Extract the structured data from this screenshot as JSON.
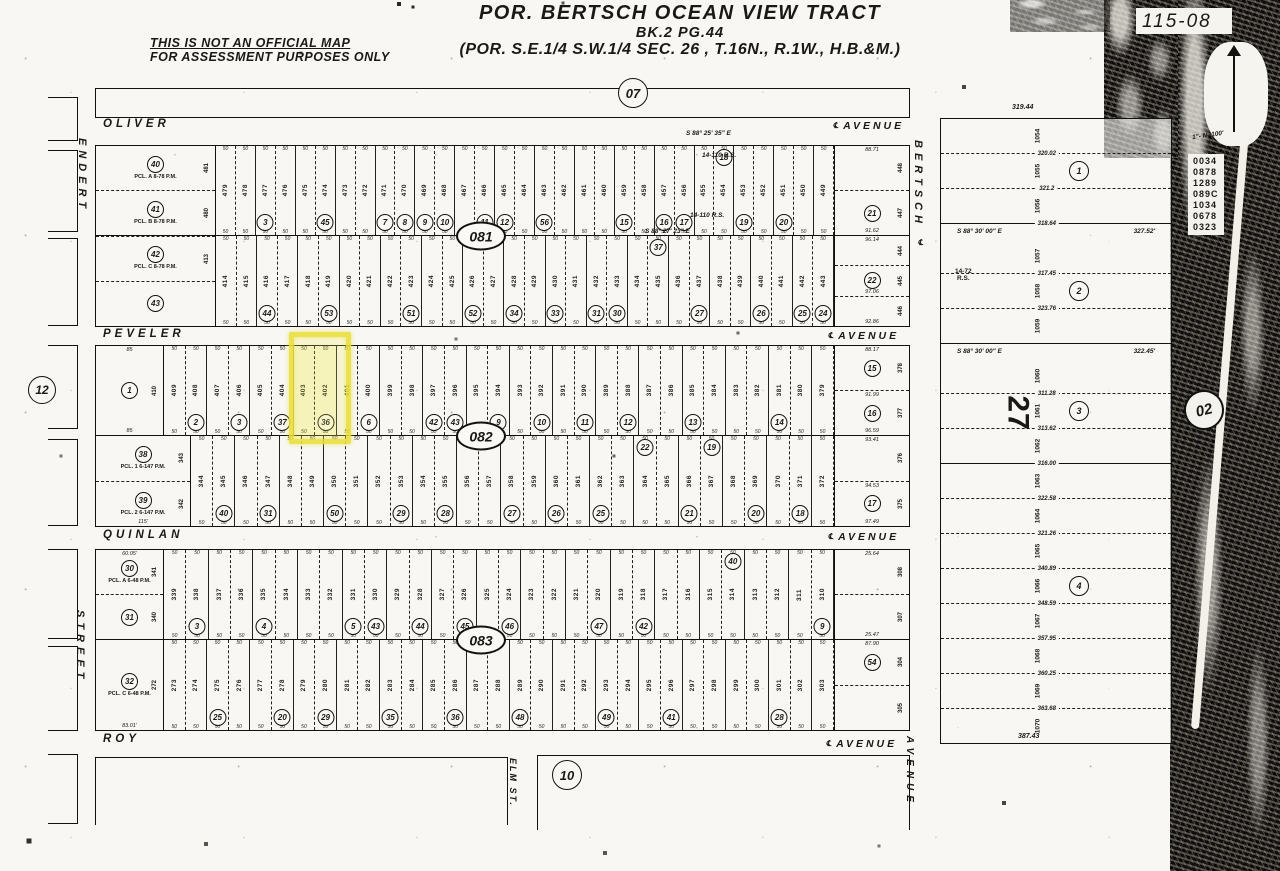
{
  "header": {
    "title_line1": "POR. BERTSCH OCEAN VIEW TRACT",
    "title_line2": "BK.2 PG.44",
    "title_line3": "(POR.  S.E.1/4  S.W.1/4  SEC. 26 ,  T.16N.,  R.1W.,  H.B.&M.)",
    "disclaimer_line1": "THIS IS NOT AN OFFICIAL MAP",
    "disclaimer_line2": "FOR ASSESSMENT PURPOSES ONLY",
    "sheet_number": "115-08",
    "north_scale": "1\"- N -100'"
  },
  "block_labels": {
    "b07": "07",
    "b081": "081",
    "b082": "082",
    "b083": "083",
    "b10": "10",
    "b12": "12",
    "b02": "02"
  },
  "streets": {
    "oliver": {
      "name": "OLIVER",
      "type": "AVENUE"
    },
    "peveler": {
      "name": "PEVELER",
      "type": "AVENUE"
    },
    "quinlan": {
      "name": "QUINLAN",
      "type": "AVENUE"
    },
    "roy": {
      "name": "ROY",
      "type": "AVENUE"
    },
    "endert": {
      "name": "ENDERT",
      "type": "STREET"
    },
    "bertsch": {
      "name": "BERTSCH",
      "type": "AVENUE"
    },
    "elm": {
      "name": "ELM ST."
    },
    "centerline_symbol": "℄"
  },
  "dims": {
    "lot_width": "50"
  },
  "notes": {
    "rs_110_a": "14-110 R.S.",
    "rs_110_b": "14-110 R.S.",
    "bearing_top": "S 88° 25' 35\" E",
    "bearing_mid": "S 88° 27' 23\" E",
    "rs_72": "14-72\nR.S."
  },
  "highlight": {
    "parcel_circle": "36",
    "lots": [
      "403",
      "402"
    ],
    "color": "#e8de3a"
  },
  "grid": {
    "b081": {
      "corner_left": [
        {
          "circle": "40",
          "note": "PCL. A 8-78 P.M.",
          "lot": "481"
        },
        {
          "circle": "41",
          "note": "PCL. B 8-78 P.M.",
          "lot": "480"
        },
        {
          "circle": "42",
          "note": "PCL. C 8-78 P.M.",
          "lot": "413"
        },
        {
          "circle": "43"
        }
      ],
      "rowA": {
        "lots": [
          "479",
          "478",
          {
            "n": "477",
            "c": "3"
          },
          "476",
          "475",
          {
            "n": "474",
            "c": "45"
          },
          "473",
          "472",
          {
            "n": "471",
            "c": "7"
          },
          {
            "n": "470",
            "c": "8"
          },
          {
            "n": "469",
            "c": "9"
          },
          {
            "n": "468",
            "c": "10"
          },
          "467",
          {
            "n": "466",
            "c": "11"
          },
          {
            "n": "465",
            "c": "12"
          },
          "464",
          {
            "n": "463",
            "c": "56"
          },
          "462",
          "461",
          "460",
          {
            "n": "459",
            "c": "15"
          },
          "458",
          {
            "n": "457",
            "c": "16"
          },
          {
            "n": "456",
            "c": "17"
          },
          "455",
          {
            "n": "454",
            "c": "18",
            "t": true
          },
          {
            "n": "453",
            "c": "19"
          },
          "452",
          {
            "n": "451",
            "c": "20"
          },
          "450",
          "449"
        ],
        "corner_right": [
          {
            "lot": "448",
            "dim_top": "88.71"
          },
          {
            "lot": "447",
            "circle": "21",
            "dim": "91.62"
          }
        ]
      },
      "rowB": {
        "lots": [
          "414",
          "415",
          {
            "n": "416",
            "c": "44"
          },
          "417",
          "418",
          {
            "n": "419",
            "c": "53"
          },
          "420",
          "421",
          "422",
          {
            "n": "423",
            "c": "51"
          },
          "424",
          "425",
          {
            "n": "426",
            "c": "52"
          },
          "427",
          {
            "n": "428",
            "c": "34"
          },
          "429",
          {
            "n": "430",
            "c": "33"
          },
          "431",
          {
            "n": "432",
            "c": "31"
          },
          {
            "n": "433",
            "c": "30"
          },
          "434",
          {
            "n": "435",
            "c": "37",
            "t": true
          },
          "436",
          {
            "n": "437",
            "c": "27"
          },
          "438",
          "439",
          {
            "n": "440",
            "c": "26"
          },
          "441",
          {
            "n": "442",
            "c": "25"
          },
          {
            "n": "443",
            "c": "24"
          }
        ],
        "corner_right": [
          {
            "lot": "444",
            "dim_top": "96.14"
          },
          {
            "lot": "445",
            "circle": "22",
            "dim": "97.06"
          },
          {
            "lot": "446",
            "dim": "92.86"
          }
        ]
      }
    },
    "b082": {
      "rowA": {
        "corner_left": [
          {
            "circle": "1",
            "lot": "410",
            "dim_top": "85",
            "dim": "85"
          }
        ],
        "lots": [
          "409",
          {
            "n": "408",
            "c": "2"
          },
          "407",
          {
            "n": "406",
            "c": "3"
          },
          "405",
          {
            "n": "404",
            "c": "37"
          },
          {
            "n": "403",
            "hl": true
          },
          {
            "n": "402",
            "c": "36",
            "hl": true
          },
          "401",
          {
            "n": "400",
            "c": "6"
          },
          "399",
          "398",
          {
            "n": "397",
            "c": "42"
          },
          {
            "n": "396",
            "c": "43"
          },
          "395",
          {
            "n": "394",
            "c": "9"
          },
          "393",
          {
            "n": "392",
            "c": "10"
          },
          "391",
          {
            "n": "390",
            "c": "11"
          },
          "389",
          {
            "n": "388",
            "c": "12"
          },
          "387",
          "386",
          {
            "n": "385",
            "c": "13"
          },
          "384",
          "383",
          "382",
          {
            "n": "381",
            "c": "14"
          },
          "380",
          "379"
        ],
        "corner_right": [
          {
            "lot": "378",
            "circle": "15",
            "dim_top": "88.17"
          },
          {
            "lot": "377",
            "circle": "16",
            "dim_top": "91.99",
            "dim": "96.59"
          }
        ]
      },
      "rowB": {
        "corner_left": [
          {
            "circle": "38",
            "lot": "343",
            "note": "PCL. 1 6-147 P.M."
          },
          {
            "circle": "39",
            "lot": "342",
            "note": "PCL. 2 6-147 P.M.",
            "dim": "115'"
          }
        ],
        "lots": [
          "344",
          {
            "n": "345",
            "c": "40"
          },
          "346",
          {
            "n": "347",
            "c": "31"
          },
          "348",
          "349",
          {
            "n": "350",
            "c": "50"
          },
          "351",
          "352",
          {
            "n": "353",
            "c": "29"
          },
          "354",
          {
            "n": "355",
            "c": "28"
          },
          "356",
          "357",
          {
            "n": "358",
            "c": "27"
          },
          "359",
          {
            "n": "360",
            "c": "26"
          },
          "361",
          {
            "n": "362",
            "c": "25"
          },
          "363",
          {
            "n": "364",
            "c": "22",
            "t": true
          },
          "365",
          {
            "n": "366",
            "c": "21"
          },
          {
            "n": "367",
            "c": "19",
            "t": true
          },
          "368",
          {
            "n": "369",
            "c": "20"
          },
          "370",
          {
            "n": "371",
            "c": "18"
          },
          "372"
        ],
        "corner_right": [
          {
            "lot": "376",
            "dim_top": "93.41"
          },
          {
            "lot": "375",
            "circle": "17",
            "dim_top": "94.53",
            "dim": "97.49"
          }
        ]
      }
    },
    "b083": {
      "rowA": {
        "corner_left": [
          {
            "circle": "30",
            "lot": "341",
            "note": "PCL. A 6-48 P.M.",
            "dim_top": "60.05'"
          },
          {
            "circle": "31",
            "lot": "340"
          }
        ],
        "lots": [
          "339",
          {
            "n": "338",
            "c": "3"
          },
          "337",
          "336",
          {
            "n": "335",
            "c": "4"
          },
          "334",
          "333",
          "332",
          {
            "n": "331",
            "c": "5"
          },
          {
            "n": "330",
            "c": "43"
          },
          "329",
          {
            "n": "328",
            "c": "44"
          },
          "327",
          {
            "n": "326",
            "c": "45"
          },
          "325",
          {
            "n": "324",
            "c": "46"
          },
          "323",
          "322",
          "321",
          {
            "n": "320",
            "c": "47"
          },
          "319",
          {
            "n": "318",
            "c": "42"
          },
          "317",
          "316",
          "315",
          {
            "n": "314",
            "c": "40",
            "t": true
          },
          "313",
          "312",
          "311",
          {
            "n": "310",
            "c": "9"
          }
        ],
        "corner_right": [
          {
            "lot": "308",
            "dim_top": "25.64"
          },
          {
            "lot": "307",
            "dim": "25.47"
          }
        ]
      },
      "rowB": {
        "corner_left": [
          {
            "circle": "32",
            "lot": "272",
            "note": "PCL. C 6-48 P.M.",
            "dim": "83.01'"
          }
        ],
        "lots": [
          "273",
          "274",
          {
            "n": "275",
            "c": "25"
          },
          "276",
          "277",
          {
            "n": "278",
            "c": "20"
          },
          "279",
          {
            "n": "280",
            "c": "29"
          },
          "281",
          "282",
          {
            "n": "283",
            "c": "35"
          },
          "284",
          "285",
          {
            "n": "286",
            "c": "36"
          },
          "287",
          "288",
          {
            "n": "289",
            "c": "48"
          },
          "290",
          "291",
          "292",
          {
            "n": "293",
            "c": "49"
          },
          "294",
          "295",
          {
            "n": "296",
            "c": "41"
          },
          "297",
          "298",
          "299",
          "300",
          {
            "n": "301",
            "c": "28"
          },
          "302",
          "303"
        ],
        "corner_right": [
          {
            "lot": "304",
            "circle": "54",
            "dim_top": "87.90"
          },
          {
            "lot": "305"
          }
        ]
      }
    }
  },
  "east_tract": {
    "dim_top": "319.44",
    "dim_bottom": "387.43",
    "section_label": "27",
    "strips": [
      {
        "lot": "1054",
        "dim": "320.02"
      },
      {
        "lot": "1055",
        "circle": "1",
        "dim": "321.2"
      },
      {
        "lot": "1056",
        "dim": "318.64",
        "solid": true
      },
      {
        "bearing": "S 88° 30' 00\" E",
        "dist": "327.52'"
      },
      {
        "lot": "1057",
        "dim": "317.45"
      },
      {
        "lot": "1058",
        "circle": "2",
        "dim": "323.76"
      },
      {
        "lot": "1059",
        "solid": true
      },
      {
        "bearing": "S 88° 30' 00\" E",
        "dist": "322.45'"
      },
      {
        "lot": "1060",
        "dim": "311.28"
      },
      {
        "lot": "1061",
        "circle": "3",
        "dim": "313.62"
      },
      {
        "lot": "1062",
        "dim": "316.00",
        "solid": true
      },
      {
        "lot": "1063",
        "dim": "322.58"
      },
      {
        "lot": "1064",
        "dim": "321.26"
      },
      {
        "lot": "1065",
        "dim": "340.89"
      },
      {
        "lot": "1066",
        "circle": "4",
        "dim": "348.59"
      },
      {
        "lot": "1067",
        "dim": "357.95"
      },
      {
        "lot": "1068",
        "dim": "360.25"
      },
      {
        "lot": "1069",
        "dim": "363.68"
      },
      {
        "lot": "1070"
      }
    ]
  },
  "margin_numbers": [
    "0034",
    "0878",
    "1289",
    "089C",
    "1034",
    "0678",
    "0323"
  ]
}
